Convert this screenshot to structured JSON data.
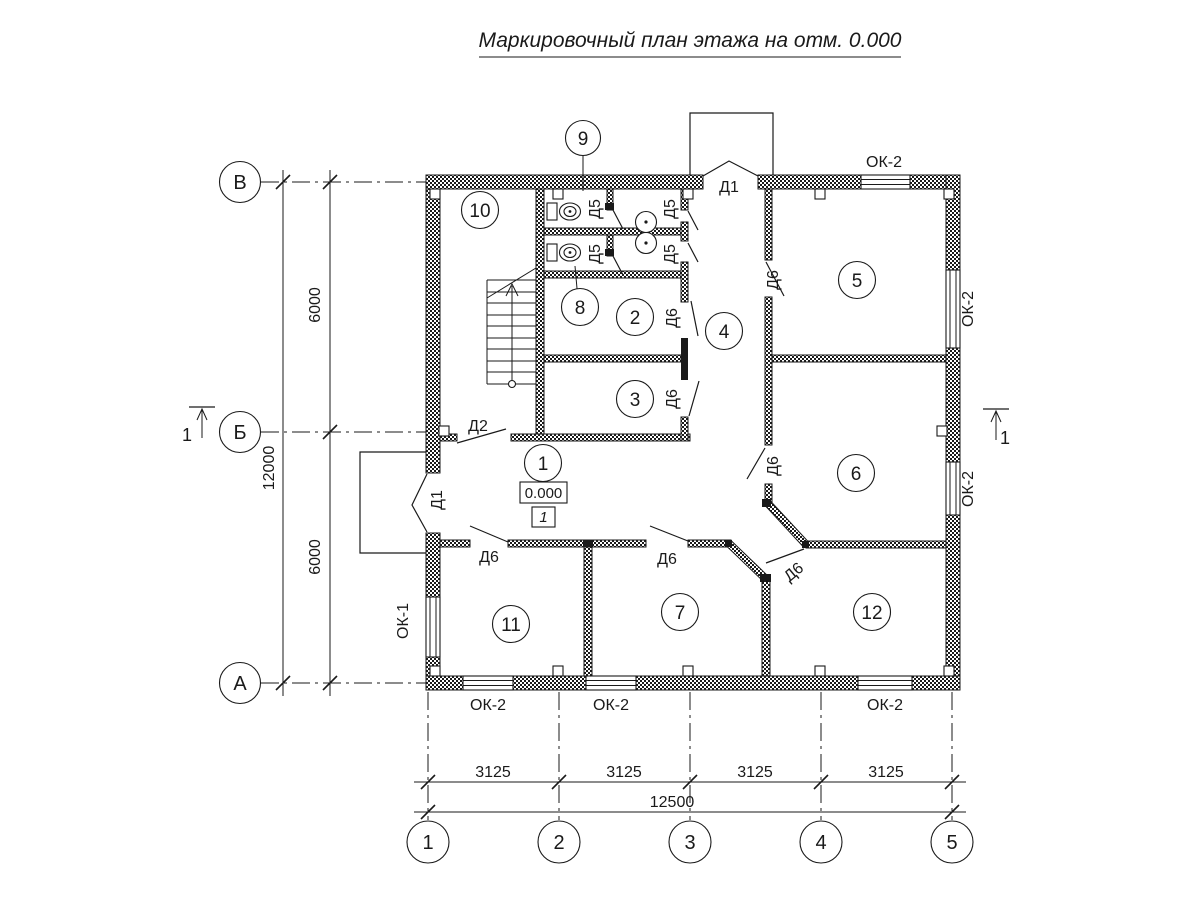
{
  "title": "Маркировочный план этажа на отм. 0.000",
  "axes": {
    "rows": [
      "В",
      "Б",
      "А"
    ],
    "cols": [
      "1",
      "2",
      "3",
      "4",
      "5"
    ]
  },
  "dims": {
    "left": {
      "segments": [
        "6000",
        "6000"
      ],
      "total": "12000"
    },
    "bottom": {
      "segments": [
        "3125",
        "3125",
        "3125",
        "3125"
      ],
      "total": "12500"
    }
  },
  "rooms": {
    "r1": "1",
    "r2": "2",
    "r3": "3",
    "r4": "4",
    "r5": "5",
    "r6": "6",
    "r7": "7",
    "r8": "8",
    "r9": "9",
    "r10": "10",
    "r11": "11",
    "r12": "12"
  },
  "doors": {
    "d1": "Д1",
    "d2": "Д2",
    "d5": "Д5",
    "d6": "Д6"
  },
  "windows": {
    "ok1": "ОК-1",
    "ok2": "ОК-2"
  },
  "marks": {
    "elevation": "0.000",
    "floor": "1",
    "section": "1"
  }
}
